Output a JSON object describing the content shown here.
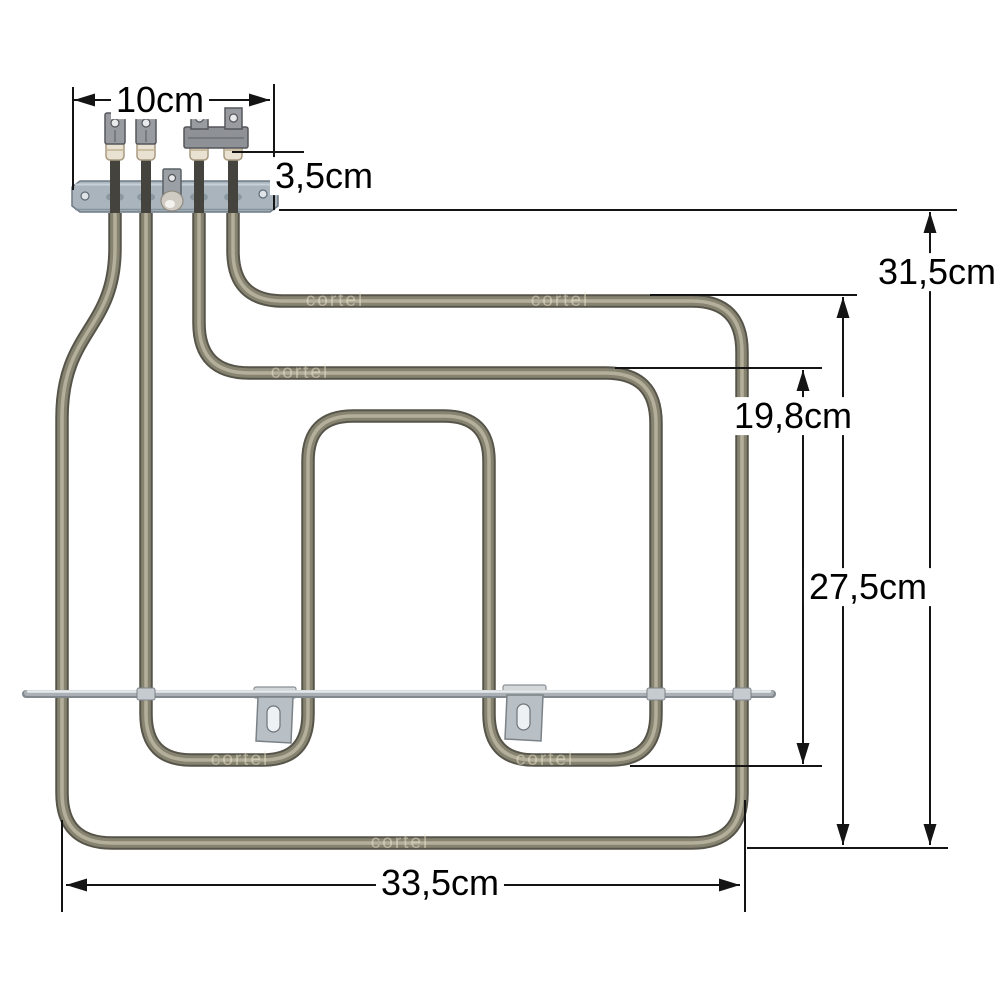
{
  "image_type": "dimensioned product photo of a dual-circuit oven grill heating element",
  "dims": {
    "top_width": "10cm",
    "terminal_offset": "3,5cm",
    "total_height": "31,5cm",
    "inner_loop_height": "19,8cm",
    "element_height": "27,5cm",
    "bottom_width": "33,5cm"
  },
  "watermark": {
    "text": "cortel"
  },
  "colors": {
    "background": "#ffffff",
    "dimension_line": "#141414",
    "tube_outline": "#57554a",
    "tube_body": "#868371",
    "tube_highlight": "#b3af9a",
    "bracket_plate": "#a9b4bd",
    "support_rod": "#aab0b5",
    "ceramic_insulator": "#e9e1d1",
    "terminal_metal": "#989ca0"
  }
}
